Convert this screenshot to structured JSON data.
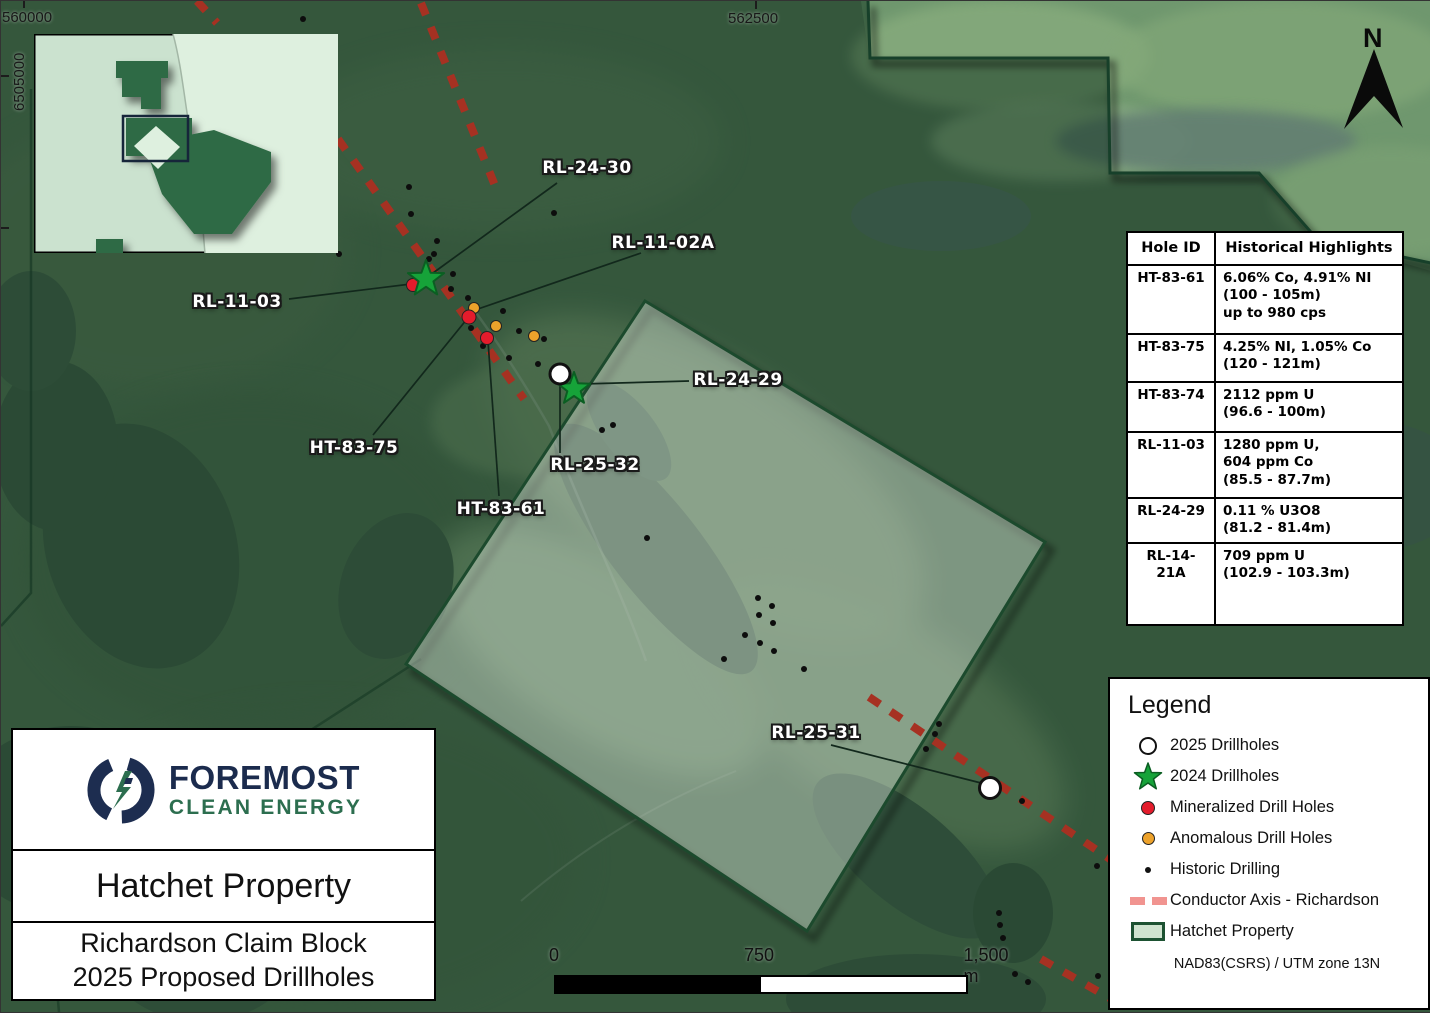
{
  "map": {
    "north_label": "N",
    "coords": {
      "easting_left": "560000",
      "easting_center": "562500",
      "northing_left": "6505000"
    },
    "drillhole_labels": [
      {
        "id": "RL-24-30"
      },
      {
        "id": "RL-11-02A"
      },
      {
        "id": "RL-11-03"
      },
      {
        "id": "HT-83-75"
      },
      {
        "id": "HT-83-61"
      },
      {
        "id": "RL-25-32"
      },
      {
        "id": "RL-24-29"
      },
      {
        "id": "RL-25-31"
      }
    ]
  },
  "table": {
    "headers": [
      "Hole ID",
      "Historical Highlights"
    ],
    "rows": [
      {
        "id": "HT-83-61",
        "highlight": "6.06% Co, 4.91% NI\n(100 - 105m)\nup to 980 cps"
      },
      {
        "id": "HT-83-75",
        "highlight": "4.25% NI, 1.05% Co\n(120 - 121m)"
      },
      {
        "id": "HT-83-74",
        "highlight": "2112 ppm U\n(96.6 - 100m)"
      },
      {
        "id": "RL-11-03",
        "highlight": "1280 ppm U,\n604 ppm Co\n(85.5 - 87.7m)"
      },
      {
        "id": "RL-24-29",
        "highlight": "0.11 % U3O8\n(81.2 - 81.4m)"
      },
      {
        "id": "RL-14-21A",
        "highlight": "709 ppm U\n(102.9 - 103.3m)"
      }
    ]
  },
  "legend": {
    "title": "Legend",
    "items": [
      {
        "symbol": "white-circle",
        "label": "2025 Drillholes"
      },
      {
        "symbol": "green-star",
        "label": "2024 Drillholes"
      },
      {
        "symbol": "red-dot",
        "label": "Mineralized Drill Holes"
      },
      {
        "symbol": "orange-dot",
        "label": "Anomalous Drill Holes"
      },
      {
        "symbol": "black-dot",
        "label": "Historic Drilling"
      },
      {
        "symbol": "pink-dashed-line",
        "label": "Conductor Axis - Richardson"
      },
      {
        "symbol": "green-rectangle",
        "label": "Hatchet Property"
      }
    ],
    "datum": "NAD83(CSRS) / UTM zone 13N"
  },
  "title_block": {
    "company_line1": "FOREMOST",
    "company_line2": "CLEAN ENERGY",
    "property": "Hatchet Property",
    "subtitle_line1": "Richardson Claim Block",
    "subtitle_line2": "2025 Proposed Drillholes"
  },
  "scale_bar": {
    "start": "0",
    "mid": "750",
    "end": "1,500 m"
  },
  "colors": {
    "star_green": "#16a339",
    "mineralized_red": "#e41c2c",
    "anomalous_orange": "#eda22b",
    "conductor_red": "#a63122",
    "conductor_legend_pink": "#f19490",
    "property_fill": "#cfe3cf",
    "property_border": "#1d5232",
    "logo_navy": "#1b2b4d",
    "logo_green": "#2c6e4f"
  }
}
